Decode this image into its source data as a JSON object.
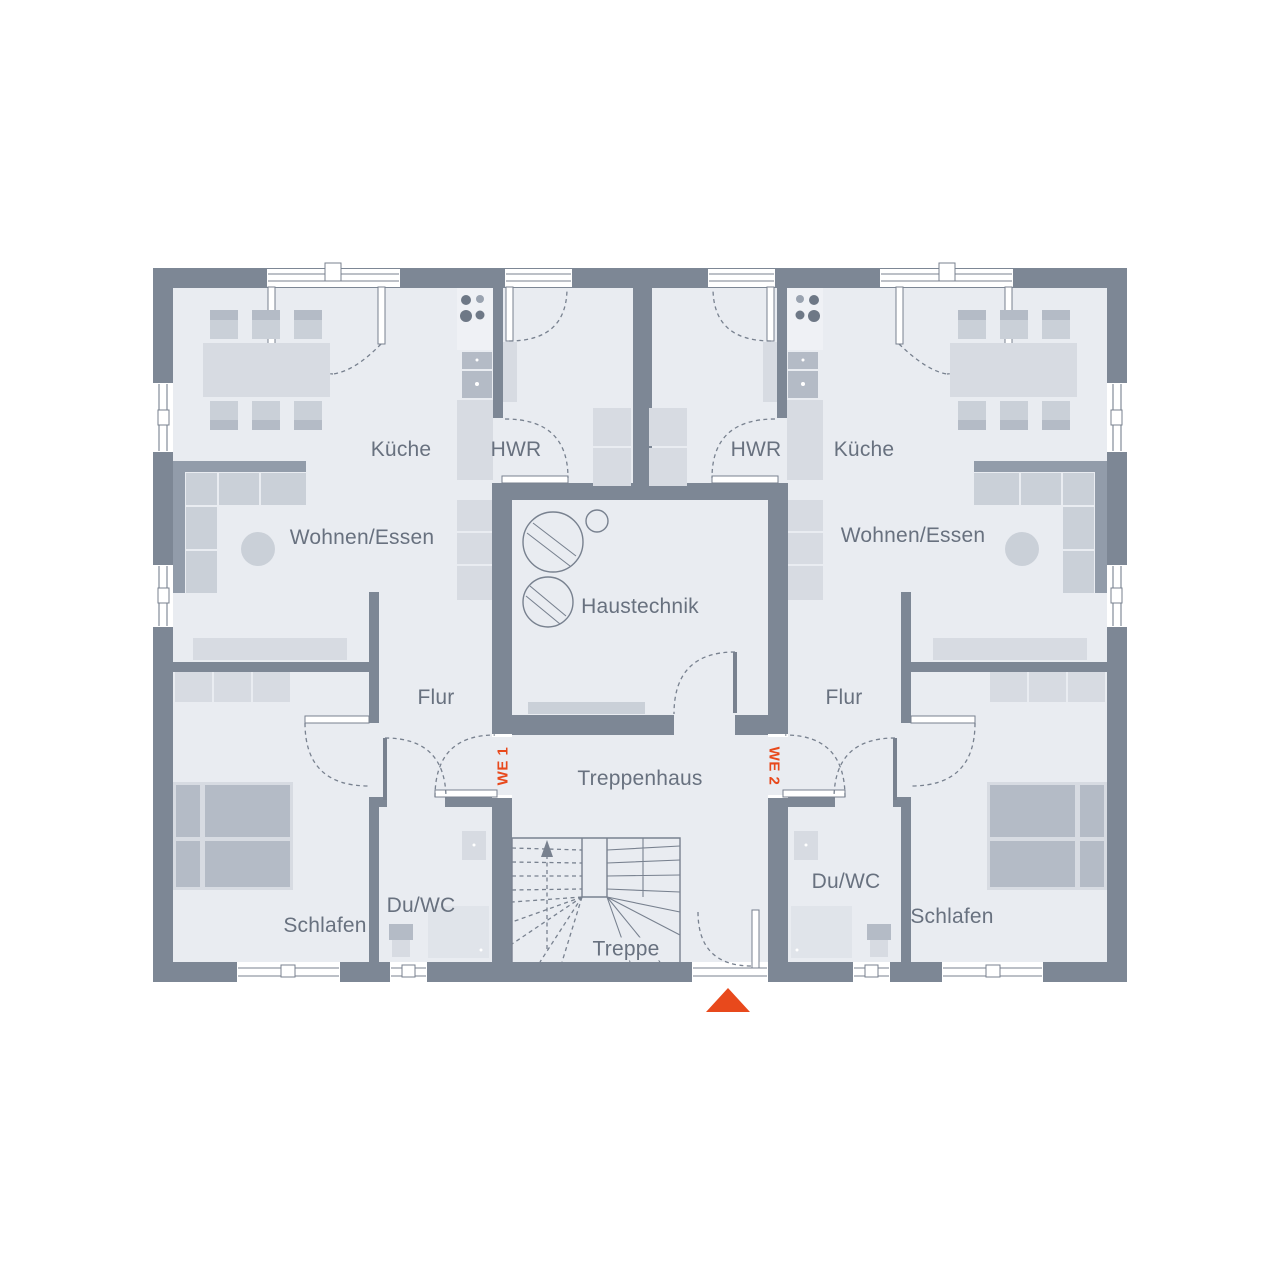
{
  "page": {
    "type": "architectural-floor-plan",
    "description": "Ground floor plan of a two-unit residential building with central stairwell"
  },
  "plan": {
    "units": [
      {
        "id": "we1",
        "label": "WE 1",
        "rooms": [
          "Küche",
          "HWR",
          "Wohnen/Essen",
          "Flur",
          "Du/WC",
          "Schlafen"
        ]
      },
      {
        "id": "we2",
        "label": "WE 2",
        "rooms": [
          "HWR",
          "Küche",
          "Wohnen/Essen",
          "Flur",
          "Du/WC",
          "Schlafen"
        ]
      }
    ],
    "shared_rooms": [
      "Haustechnik",
      "Treppenhaus",
      "Treppe"
    ]
  },
  "labels": {
    "kueche_left": "Küche",
    "hwr_left": "HWR",
    "hwr_right": "HWR",
    "kueche_right": "Küche",
    "wohnen_left": "Wohnen/Essen",
    "wohnen_right": "Wohnen/Essen",
    "haustechnik": "Haustechnik",
    "flur_left": "Flur",
    "flur_right": "Flur",
    "treppenhaus": "Treppenhaus",
    "treppe": "Treppe",
    "duwc_left": "Du/WC",
    "duwc_right": "Du/WC",
    "schlafen_left": "Schlafen",
    "schlafen_right": "Schlafen",
    "we1": "WE 1",
    "we2": "WE 2"
  },
  "markers": {
    "entrance": "red-triangle-up"
  },
  "theme": {
    "background": "#ffffff",
    "wall": "#7d8795",
    "floor": "#e9ecf1",
    "frame": "#ffffff",
    "outline": "#78818f",
    "furniture_light": "#d7dbe2",
    "furniture_mid": "#cad0d8",
    "furniture_dark": "#b4bbc6",
    "sofa_back": "#929caa",
    "counter": "#e0e4ea",
    "appliance": "#eff1f5",
    "burner_dark": "#6e7886",
    "burner_mid": "#9aa3b0",
    "label_text": "#68717f",
    "accent": "#e8491c"
  }
}
